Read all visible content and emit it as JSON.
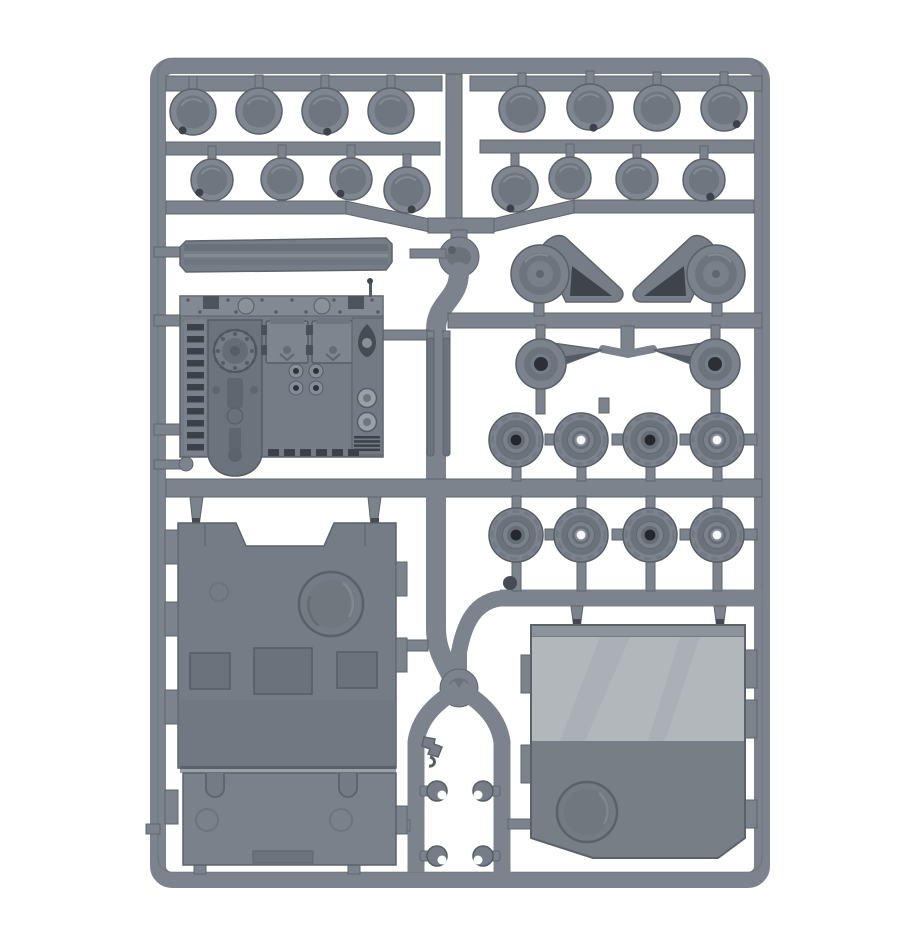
{
  "image": {
    "alt": "Product photo of a grey plastic model-kit sprue containing tank vehicle parts on a white background",
    "background_color": "#ffffff"
  },
  "colors": {
    "background": "#ffffff",
    "sprue": "#7d838c",
    "sprue_edge": "#5e646c",
    "sprue_shadow": "#686e77",
    "part_face": "#767d86",
    "part_dark": "#3f444c",
    "detail_dark": "#454a51",
    "hub_dark": "#24282e",
    "hub_hole": "#f7f8f9",
    "panel_light": "#b2b7bc",
    "panel_mid": "#757c85",
    "panel_dark": "#787e86"
  },
  "sprue": {
    "material": "grey polystyrene",
    "parts_inventory": [
      {
        "name": "hub-cap-discs-top-left",
        "count": 8
      },
      {
        "name": "hub-cap-discs-top-right",
        "count": 8
      },
      {
        "name": "track-guard-rail",
        "count": 1
      },
      {
        "name": "vehicle-front-armour-plate",
        "count": 1
      },
      {
        "name": "thin-strip-parts",
        "count": 2
      },
      {
        "name": "drive-sprocket-housings",
        "count": 2
      },
      {
        "name": "axle-hub-parts",
        "count": 2
      },
      {
        "name": "road-wheels",
        "count": 8
      },
      {
        "name": "large-hull-roof-panel",
        "count": 1
      },
      {
        "name": "rear-ramp-door-panel",
        "count": 1
      },
      {
        "name": "tow-hooks",
        "count": 4
      },
      {
        "name": "periscope-part",
        "count": 1
      }
    ],
    "wheel_groups": [
      {
        "id": "hubcaps-top-left-row1",
        "style": "cup",
        "wheels": [
          {
            "cx": 193,
            "cy": 112,
            "r": 23,
            "notch": [
              -0.45,
              0.8
            ]
          },
          {
            "cx": 259,
            "cy": 111,
            "r": 23
          },
          {
            "cx": 325,
            "cy": 111,
            "r": 23,
            "notch": [
              0.1,
              0.9
            ]
          },
          {
            "cx": 391,
            "cy": 111,
            "r": 23
          }
        ]
      },
      {
        "id": "hubcaps-top-left-row2",
        "style": "cup",
        "wheels": [
          {
            "cx": 212,
            "cy": 180,
            "r": 21,
            "notch": [
              -0.6,
              0.6
            ]
          },
          {
            "cx": 282,
            "cy": 179,
            "r": 21
          },
          {
            "cx": 351,
            "cy": 179,
            "r": 21,
            "notch": [
              -0.5,
              0.7
            ]
          },
          {
            "cx": 407,
            "cy": 190,
            "r": 23,
            "notch": [
              0.2,
              0.85
            ]
          }
        ]
      },
      {
        "id": "hubcaps-top-right-row1",
        "style": "cup",
        "wheels": [
          {
            "cx": 522,
            "cy": 109,
            "r": 23
          },
          {
            "cx": 590,
            "cy": 107,
            "r": 23,
            "notch": [
              0.15,
              0.9
            ]
          },
          {
            "cx": 657,
            "cy": 108,
            "r": 23
          },
          {
            "cx": 724,
            "cy": 108,
            "r": 23,
            "notch": [
              0.55,
              0.7
            ]
          }
        ]
      },
      {
        "id": "hubcaps-top-right-row2",
        "style": "cup",
        "wheels": [
          {
            "cx": 515,
            "cy": 189,
            "r": 23,
            "notch": [
              -0.2,
              0.85
            ]
          },
          {
            "cx": 570,
            "cy": 178,
            "r": 21
          },
          {
            "cx": 637,
            "cy": 179,
            "r": 21
          },
          {
            "cx": 704,
            "cy": 180,
            "r": 21,
            "notch": [
              0.3,
              0.8
            ]
          }
        ]
      },
      {
        "id": "road-wheels-row1",
        "style": "road",
        "wheels": [
          {
            "cx": 516,
            "cy": 440,
            "r": 27,
            "hub": "dark"
          },
          {
            "cx": 581,
            "cy": 440,
            "r": 27,
            "hub": "hole"
          },
          {
            "cx": 650,
            "cy": 440,
            "r": 27,
            "hub": "dark"
          },
          {
            "cx": 717,
            "cy": 440,
            "r": 27,
            "hub": "hole"
          }
        ]
      },
      {
        "id": "road-wheels-row2",
        "style": "road",
        "wheels": [
          {
            "cx": 516,
            "cy": 535,
            "r": 27,
            "hub": "dark"
          },
          {
            "cx": 581,
            "cy": 535,
            "r": 27,
            "hub": "hole"
          },
          {
            "cx": 650,
            "cy": 535,
            "r": 27,
            "hub": "dark"
          },
          {
            "cx": 717,
            "cy": 535,
            "r": 27,
            "hub": "hole"
          }
        ]
      }
    ]
  }
}
